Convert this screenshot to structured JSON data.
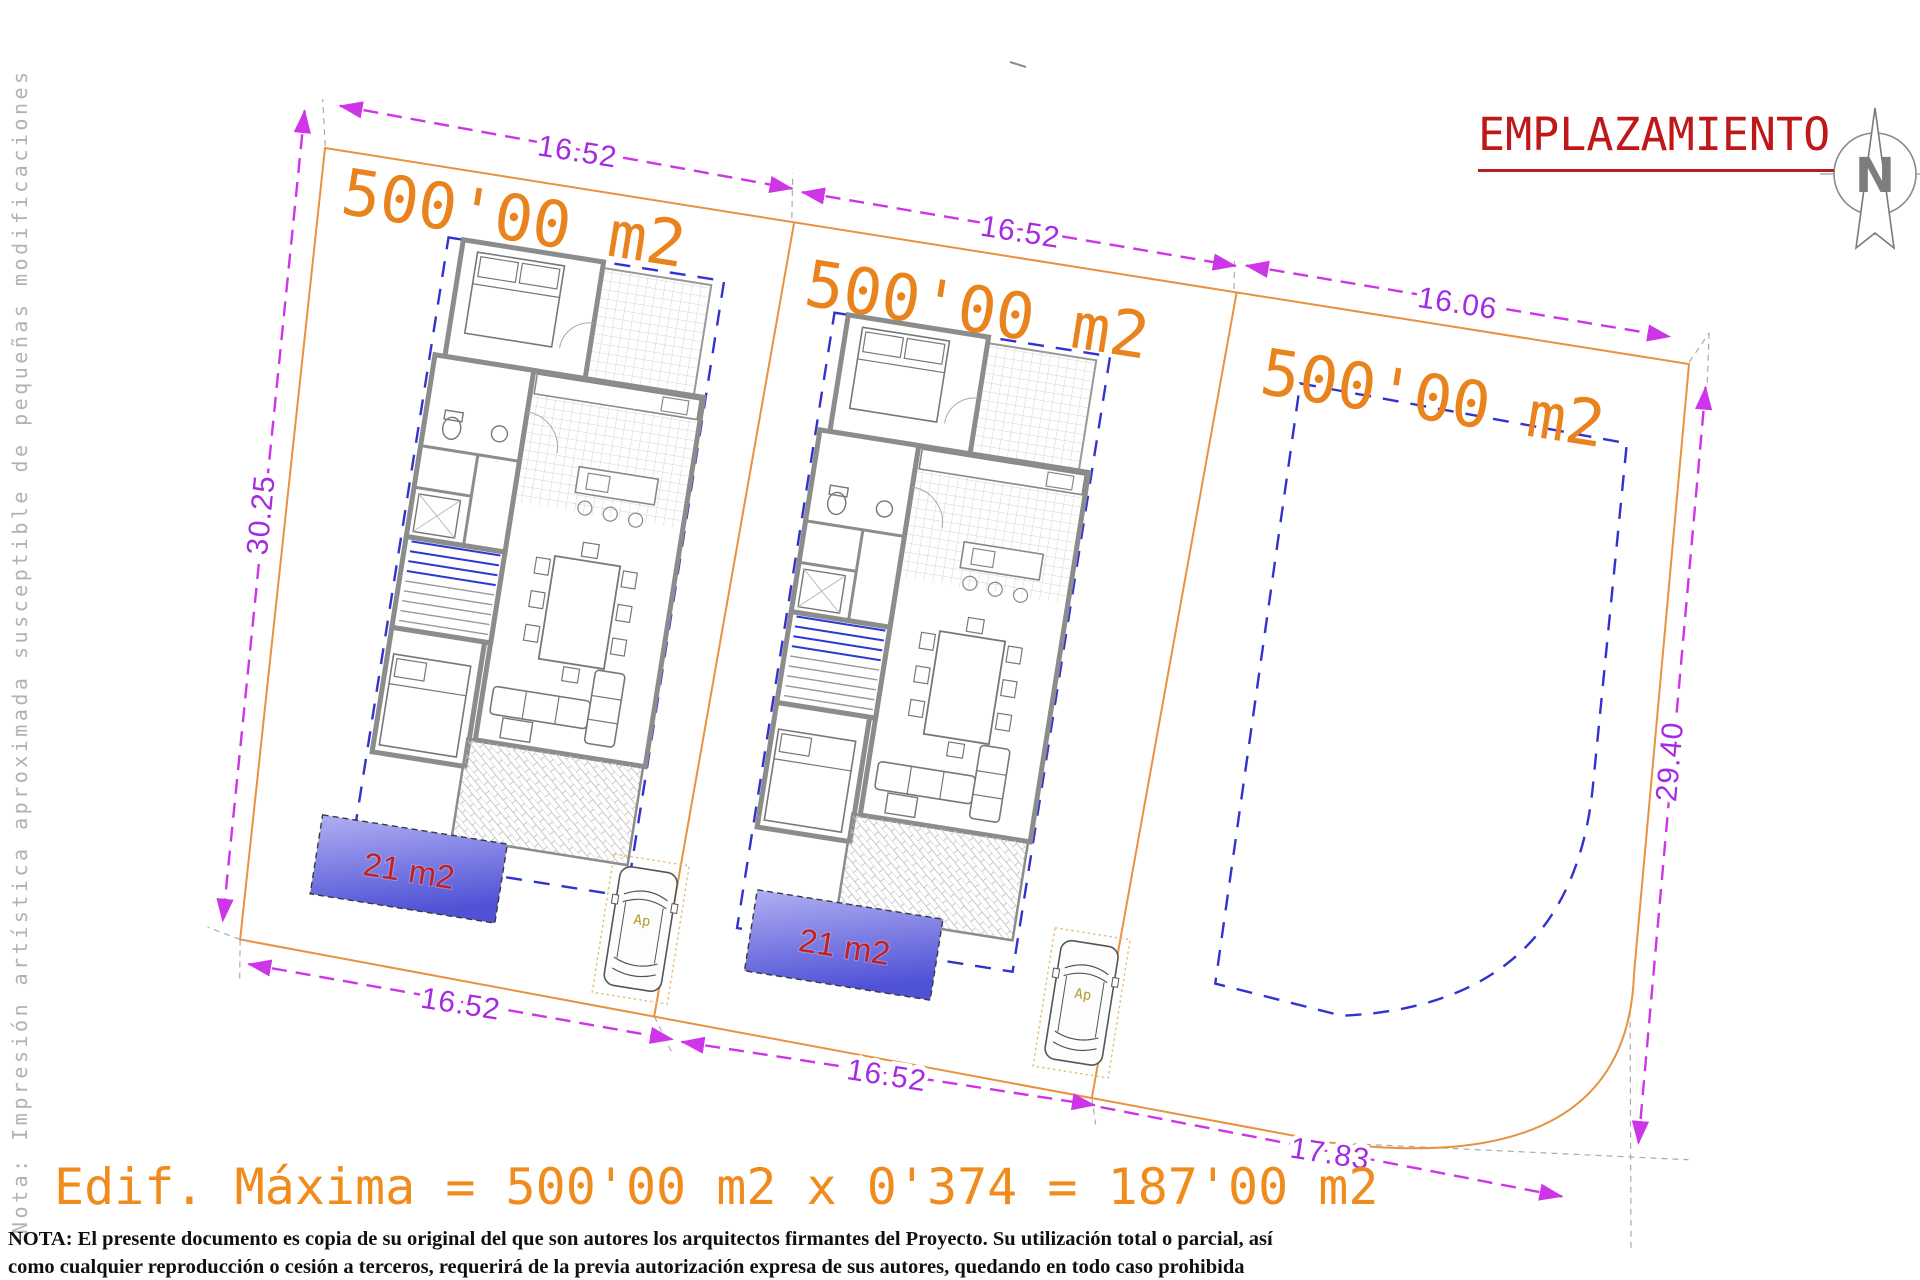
{
  "header": {
    "title": "EMPLAZAMIENTO"
  },
  "north": {
    "label": "N"
  },
  "margin_note": "Nota: Impresión artística aproximada susceptible de pequeñas modificaciones",
  "plots": [
    {
      "name": "plot-1",
      "area_label": "500'00 m2"
    },
    {
      "name": "plot-2",
      "area_label": "500'00 m2"
    },
    {
      "name": "plot-3",
      "area_label": "500'00 m2"
    }
  ],
  "pools": [
    {
      "area_label": "21 m2"
    },
    {
      "area_label": "21 m2"
    }
  ],
  "parking": [
    {
      "label": "Ap"
    },
    {
      "label": "Ap"
    }
  ],
  "dimensions": {
    "top_plot1": "16.52",
    "top_plot2": "16.52",
    "top_plot3": "16.06",
    "left_side": "30.25",
    "right_side": "29.40",
    "bottom_plot1": "16.52",
    "bottom_plot2": "16.52",
    "bottom_corner": "17.83"
  },
  "footer": {
    "max_edificability": "Edif. Máxima = 500'00 m2 x 0'374 = 187'00 m2",
    "nota_line1": "NOTA: El presente documento es copia de su original del que son autores los arquitectos firmantes del Proyecto. Su utilización total o parcial, así",
    "nota_line2": "como cualquier reproducción o cesión a terceros, requerirá  de la previa autorización expresa de sus autores, quedando en todo caso prohibida"
  },
  "colors": {
    "plot_boundary": "#E8923F",
    "plot_label": "#E8831D",
    "dimension_line": "#CE35E8",
    "dimension_text": "#A52BE0",
    "setback_line": "#3232D0",
    "pool_fill_light": "#A9A9F0",
    "pool_fill_dark": "#5052D6",
    "pool_label": "#C42020",
    "title_red": "#C01818",
    "note_gray": "#B2B2B2"
  }
}
